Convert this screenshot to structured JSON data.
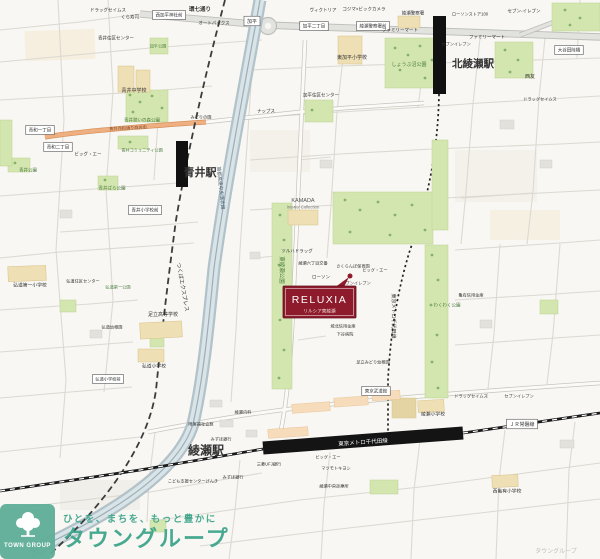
{
  "marker": {
    "title": "RELUXIA",
    "subtitle": "リルシア東綾瀬",
    "color": "#8e1b2c"
  },
  "watermark": {
    "logo_text": "TOWN GROUP",
    "tagline": "ひとを、まちを、もっと豊かに",
    "name": "タウングループ",
    "color": "#3fa58c"
  },
  "colors": {
    "marker_red": "#8e1b2c",
    "brand_green": "#3fa58c",
    "park_green": "#d4e6b0",
    "river_expressway": "#b2c2c9",
    "shopping_street_orange": "#efaf80",
    "railway_black": "#141414"
  },
  "map": {
    "labels": [
      {
        "t": "ドラッグセイムス",
        "x": 108,
        "y": 10,
        "s": 4.5
      },
      {
        "t": "くら寿司",
        "x": 130,
        "y": 17,
        "s": 4.5
      },
      {
        "t": "西加平神社前",
        "x": 169,
        "y": 15,
        "s": 4.5,
        "box": true
      },
      {
        "t": "環七通り",
        "x": 200,
        "y": 9,
        "s": 5.5,
        "b": true,
        "n": "kannana-dori-label"
      },
      {
        "t": "オートバックス",
        "x": 214,
        "y": 23,
        "s": 4.5
      },
      {
        "t": "加平",
        "x": 252,
        "y": 21,
        "s": 5,
        "box": true,
        "n": "kahei-ic-label"
      },
      {
        "t": "ヴィクトリア",
        "x": 323,
        "y": 10,
        "s": 4.5
      },
      {
        "t": "コジマ×ビックカメラ",
        "x": 364,
        "y": 9,
        "s": 4.5
      },
      {
        "t": "綾瀬警察署",
        "x": 413,
        "y": 13,
        "s": 4.5
      },
      {
        "t": "加平二丁目",
        "x": 314,
        "y": 26,
        "s": 4.5,
        "box": true
      },
      {
        "t": "綾瀬警察署前",
        "x": 373,
        "y": 26,
        "s": 4.5,
        "box": true
      },
      {
        "t": "セブン-イレブン",
        "x": 524,
        "y": 11,
        "s": 4.5
      },
      {
        "t": "ローソンストア100",
        "x": 470,
        "y": 14,
        "s": 4.2
      },
      {
        "t": "大谷田陸橋",
        "x": 569,
        "y": 50,
        "s": 4.5,
        "box": true
      },
      {
        "t": "ファミリーマート",
        "x": 400,
        "y": 30,
        "s": 4.5
      },
      {
        "t": "ファミリーマート",
        "x": 487,
        "y": 37,
        "s": 4.5
      },
      {
        "t": "セブンイレブン",
        "x": 456,
        "y": 44,
        "s": 4.2
      },
      {
        "t": "北綾瀬駅",
        "x": 452,
        "y": 63,
        "s": 10.5,
        "b": true,
        "a": "start",
        "n": "kita-ayase-station-label"
      },
      {
        "t": "しょうぶ沼公園",
        "x": 409,
        "y": 64,
        "s": 5,
        "c": "#4a7c3f"
      },
      {
        "t": "西友",
        "x": 530,
        "y": 76,
        "s": 5
      },
      {
        "t": "ドラッグセイムス",
        "x": 540,
        "y": 99,
        "s": 4.2
      },
      {
        "t": "青井住区センター",
        "x": 116,
        "y": 38,
        "s": 4.5
      },
      {
        "t": "加平公園",
        "x": 158,
        "y": 46,
        "s": 4.2,
        "c": "#4a7c3f"
      },
      {
        "t": "青井中学校",
        "x": 134,
        "y": 90,
        "s": 5
      },
      {
        "t": "東加平小学校",
        "x": 352,
        "y": 57,
        "s": 5
      },
      {
        "t": "加平住区センター",
        "x": 321,
        "y": 95,
        "s": 4.5
      },
      {
        "t": "青井憩いの森公園",
        "x": 142,
        "y": 120,
        "s": 4.5,
        "c": "#4a7c3f"
      },
      {
        "t": "青和一丁目",
        "x": 40,
        "y": 130,
        "s": 4.5,
        "box": true
      },
      {
        "t": "青和二丁目",
        "x": 58,
        "y": 147,
        "s": 4.5,
        "box": true
      },
      {
        "t": "青井兵和通り商店街",
        "x": 128,
        "y": 128,
        "s": 4.2,
        "rot": -3,
        "c": "#7a4a28"
      },
      {
        "t": "ビッグ・エー",
        "x": 88,
        "y": 154,
        "s": 4.5
      },
      {
        "t": "青井コミュニティ公園",
        "x": 142,
        "y": 150,
        "s": 4.2,
        "c": "#4a7c3f"
      },
      {
        "t": "青井公園",
        "x": 28,
        "y": 170,
        "s": 4.5,
        "c": "#4a7c3f"
      },
      {
        "t": "青井ばら公園",
        "x": 112,
        "y": 188,
        "s": 4.5,
        "c": "#4a7c3f"
      },
      {
        "t": "青井小学校前",
        "x": 145,
        "y": 210,
        "s": 4.5,
        "box": true
      },
      {
        "t": "青井駅",
        "x": 200,
        "y": 172,
        "s": 11,
        "b": true,
        "n": "aoi-station-label"
      },
      {
        "t": "つくばエクスプレス",
        "x": 183,
        "y": 287,
        "s": 5.5,
        "rot": 80,
        "n": "tsukuba-express-label"
      },
      {
        "t": "首都高速中央環状線",
        "x": 221,
        "y": 188,
        "s": 4.8,
        "rot": 84,
        "c": "#46606e",
        "n": "shuto-expressway-label"
      },
      {
        "t": "ナップス",
        "x": 266,
        "y": 111,
        "s": 4.5
      },
      {
        "t": "みどりの園",
        "x": 201,
        "y": 117,
        "s": 4.2
      },
      {
        "t": "KAMADA",
        "x": 303,
        "y": 200,
        "s": 5.5,
        "c": "#555555"
      },
      {
        "t": "Interior Collection",
        "x": 303,
        "y": 207,
        "s": 4.2,
        "c": "#777777"
      },
      {
        "t": "東綾瀬公園",
        "x": 282,
        "y": 270,
        "s": 5.5,
        "rot": 90,
        "c": "#4a7c3f",
        "n": "higashi-ayase-park-label"
      },
      {
        "t": "ツルハドラッグ",
        "x": 297,
        "y": 251,
        "s": 4.5
      },
      {
        "t": "綾瀬六丁目交番",
        "x": 313,
        "y": 263,
        "s": 4.2
      },
      {
        "t": "さくらんぼ保育園",
        "x": 353,
        "y": 266,
        "s": 4.2
      },
      {
        "t": "ローソン",
        "x": 321,
        "y": 277,
        "s": 4.5
      },
      {
        "t": "ビッグ・エー",
        "x": 375,
        "y": 270,
        "s": 4.2
      },
      {
        "t": "セブンイレブン",
        "x": 356,
        "y": 283,
        "s": 4.2
      },
      {
        "t": "わくわく公園",
        "x": 447,
        "y": 305,
        "s": 4.5,
        "c": "#4a7c3f"
      },
      {
        "t": "亀有信用金庫",
        "x": 471,
        "y": 295,
        "s": 4.2
      },
      {
        "t": "バーミヤン",
        "x": 333,
        "y": 316,
        "s": 4.5
      },
      {
        "t": "城北信用金庫",
        "x": 343,
        "y": 326,
        "s": 4.2
      },
      {
        "t": "下谷病院",
        "x": 345,
        "y": 334,
        "s": 4.2
      },
      {
        "t": "足立みどり幼稚園",
        "x": 373,
        "y": 362,
        "s": 4.2
      },
      {
        "t": "東京メトロ千代田線",
        "x": 394,
        "y": 316,
        "s": 5,
        "rot": 90,
        "n": "chiyoda-line-label"
      },
      {
        "t": "東京武道館",
        "x": 376,
        "y": 391,
        "s": 4.5,
        "box": true,
        "n": "tokyo-budokan-label"
      },
      {
        "t": "綾瀬内科",
        "x": 243,
        "y": 412,
        "s": 4.2
      },
      {
        "t": "障害福祉会館",
        "x": 201,
        "y": 424,
        "s": 4.2
      },
      {
        "t": "みずほ銀行",
        "x": 221,
        "y": 439,
        "s": 4.2
      },
      {
        "t": "三菱UFJ銀行",
        "x": 269,
        "y": 464,
        "s": 4.2
      },
      {
        "t": "みずほ銀行",
        "x": 233,
        "y": 477,
        "s": 4.2
      },
      {
        "t": "綾瀬駅",
        "x": 206,
        "y": 450,
        "s": 12,
        "b": true,
        "n": "ayase-station-label"
      },
      {
        "t": "東京メトロ千代田線",
        "x": 363,
        "y": 442,
        "s": 5.5,
        "c": "#ffffff",
        "rot": -4,
        "n": "chiyoda-line-on-track-label"
      },
      {
        "t": "ＪＲ常磐線",
        "x": 522,
        "y": 424,
        "s": 5,
        "box": true,
        "n": "jr-joban-line-label"
      },
      {
        "t": "ビッグ・エー",
        "x": 328,
        "y": 457,
        "s": 4.2
      },
      {
        "t": "マツモトキヨシ",
        "x": 336,
        "y": 468,
        "s": 4.2
      },
      {
        "t": "綾瀬中央診療所",
        "x": 334,
        "y": 486,
        "s": 4.2
      },
      {
        "t": "こども支援センターげんき",
        "x": 193,
        "y": 481,
        "s": 4.2
      },
      {
        "t": "綾瀬小学校",
        "x": 433,
        "y": 414,
        "s": 4.8
      },
      {
        "t": "ドラッグセイムス",
        "x": 471,
        "y": 396,
        "s": 4.2
      },
      {
        "t": "セブンイレブン",
        "x": 519,
        "y": 396,
        "s": 4.2
      },
      {
        "t": "西亀有小学校",
        "x": 507,
        "y": 491,
        "s": 4.8
      },
      {
        "t": "弘道第一小学校",
        "x": 30,
        "y": 285,
        "s": 4.8
      },
      {
        "t": "弘道住区センター",
        "x": 83,
        "y": 281,
        "s": 4.2
      },
      {
        "t": "弘道第一公園",
        "x": 118,
        "y": 287,
        "s": 4.2,
        "c": "#4a7c3f"
      },
      {
        "t": "弘道幼稚園",
        "x": 112,
        "y": 327,
        "s": 4.2
      },
      {
        "t": "足立高等学校",
        "x": 163,
        "y": 314,
        "s": 5
      },
      {
        "t": "弘道小学校",
        "x": 154,
        "y": 366,
        "s": 4.8
      },
      {
        "t": "弘道小学校前",
        "x": 108,
        "y": 379,
        "s": 4.2,
        "box": true
      },
      {
        "t": "タウングループ",
        "x": 556,
        "y": 551,
        "s": 6,
        "c": "#bfbfbf",
        "n": "corner-watermark"
      }
    ]
  }
}
